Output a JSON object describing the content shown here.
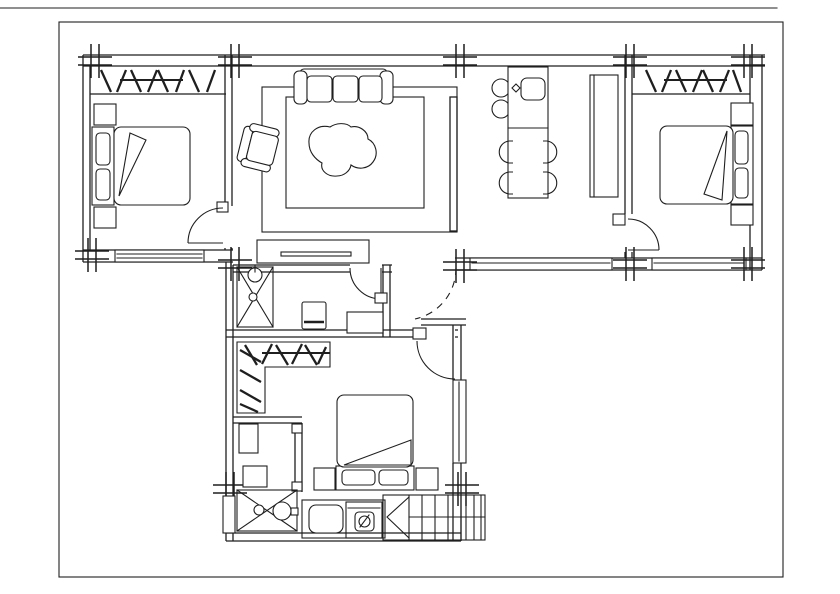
{
  "drawing": {
    "type": "architectural-floor-plan",
    "background_color": "#ffffff",
    "line_color": "#1f1f1f",
    "text_labels": [],
    "symbols": [
      "column-grid-marker",
      "window-hatch-band",
      "door-swing-arc",
      "dashed-opening-arc"
    ],
    "rooms": [
      {
        "name": "bedroom-left",
        "furniture": [
          "double-bed",
          "pillows",
          "folded-blanket",
          "nightstand-top",
          "nightstand-bottom",
          "window-bottom",
          "door-swing"
        ]
      },
      {
        "name": "living-room",
        "furniture": [
          "three-seat-sofa",
          "armchair",
          "rug",
          "organic-coffee-table",
          "tv-cabinet",
          "partition-shelf"
        ]
      },
      {
        "name": "dining-area",
        "furniture": [
          "counter-with-sink",
          "bar-stools-2",
          "dining-table",
          "dining-chairs-4",
          "tall-cabinet",
          "window-bottom"
        ]
      },
      {
        "name": "bedroom-right",
        "furniture": [
          "double-bed",
          "pillows",
          "folded-blanket",
          "nightstand-top",
          "nightstand-bottom",
          "window-bottom",
          "door-swing"
        ]
      },
      {
        "name": "bathroom",
        "furniture": [
          "shower-tray",
          "toilet",
          "washing-machine",
          "door-swing"
        ]
      },
      {
        "name": "bedroom-bottom",
        "furniture": [
          "double-bed",
          "pillows",
          "folded-blanket",
          "nightstand-left",
          "nightstand-right",
          "wardrobe-hatch-L",
          "window-right",
          "door-swing"
        ]
      },
      {
        "name": "utility-room",
        "furniture": [
          "desk",
          "stool",
          "shower-tray-with-basin",
          "water-heater"
        ]
      },
      {
        "name": "kitchen-strip",
        "furniture": [
          "counter",
          "sink",
          "cooktop",
          "staircase"
        ]
      }
    ]
  }
}
